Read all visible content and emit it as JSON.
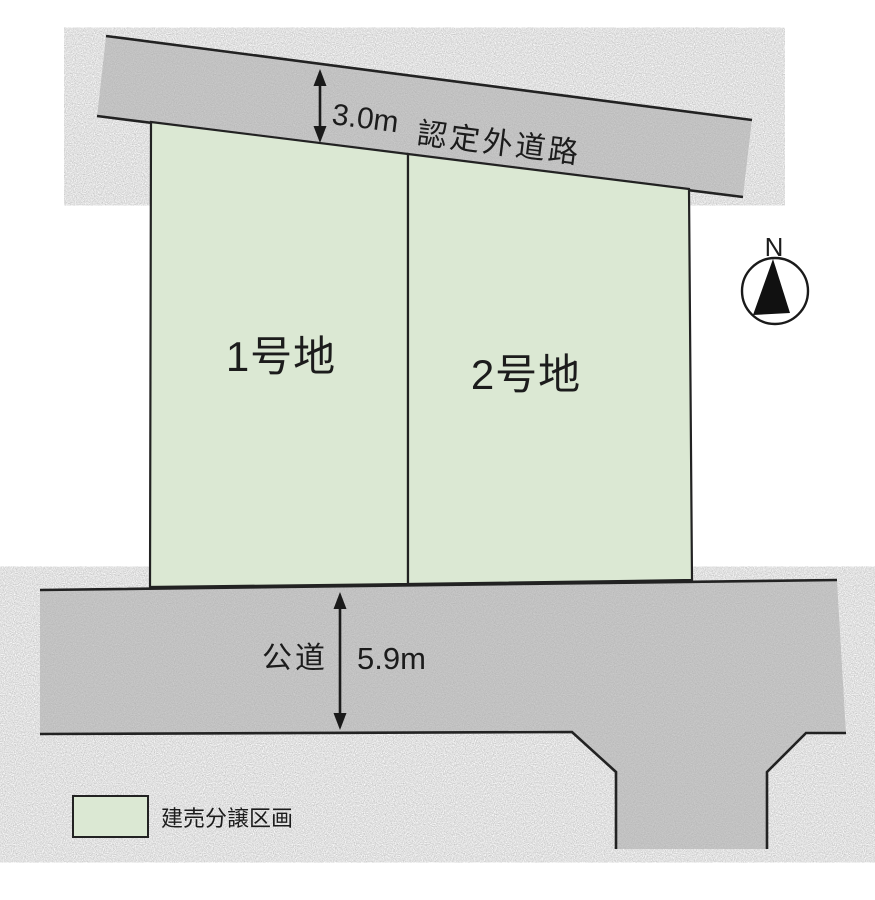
{
  "plots": [
    {
      "label": "1号地"
    },
    {
      "label": "2号地"
    }
  ],
  "roads": {
    "upper": {
      "name": "認定外道路",
      "width_label": "3.0m"
    },
    "lower": {
      "name": "公道",
      "width_label": "5.9m"
    }
  },
  "compass": {
    "north_label": "N"
  },
  "legend": {
    "label": "建売分譲区画"
  },
  "colors": {
    "plot_fill": "#dbe8d3",
    "road_fill": "#cdcdcd",
    "outline": "#222222",
    "arrow": "#1a1a1a",
    "background": "#ffffff",
    "text": "#1c1c1c"
  }
}
